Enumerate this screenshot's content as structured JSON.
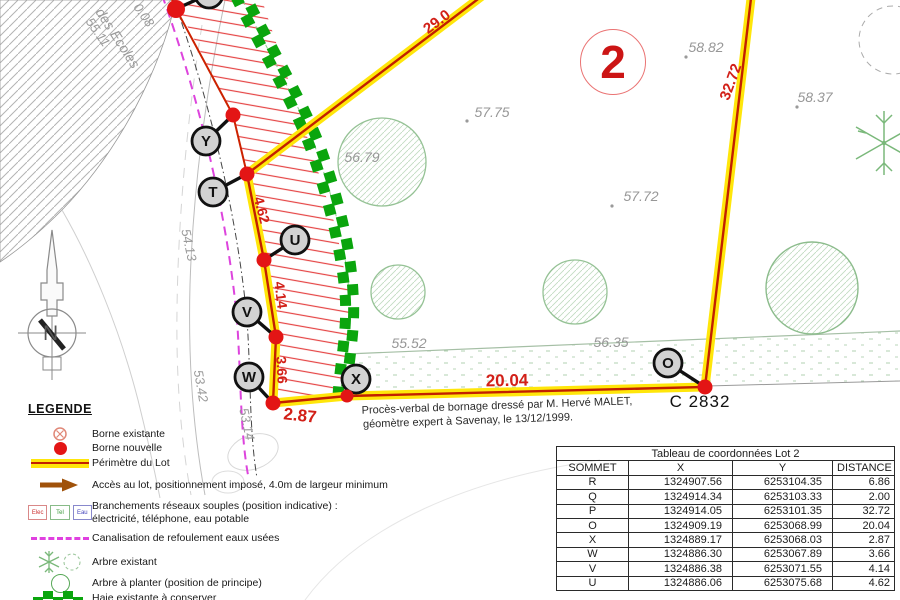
{
  "map": {
    "lot_number": "2",
    "parcel_label": "C 2832",
    "north_label": "N",
    "note_lines": [
      "Procès-verbal de bornage dressé par M. Hervé MALET,",
      "géomètre expert à Savenay, le 13/12/1999."
    ],
    "street_labels": [
      "0.08",
      "des Ecoles",
      "55.11",
      "54.13",
      "53.42",
      "53.14"
    ],
    "elevations": [
      "57.75",
      "58.82",
      "58.37",
      "57.72",
      "56.79",
      "55.52",
      "56.35"
    ],
    "segment_distances": [
      "29.0",
      "32.72",
      "4.62",
      "4.14",
      "3.66",
      "2.87",
      "20.04"
    ],
    "markers": [
      "Y",
      "T",
      "U",
      "V",
      "W",
      "X",
      "O"
    ]
  },
  "legend": {
    "title": "LEGENDE",
    "items": [
      {
        "label": "Borne existante"
      },
      {
        "label": "Borne nouvelle"
      },
      {
        "label": "Périmètre du Lot"
      },
      {
        "label": "Accès au lot, positionnement imposé, 4.0m de largeur minimum"
      },
      {
        "label": "Branchements réseaux souples (position indicative) :",
        "sublabel": "électricité, téléphone, eau potable"
      },
      {
        "label": "Canalisation de refoulement eaux usées"
      },
      {
        "label": "Arbre existant"
      },
      {
        "label": "Arbre à planter (position de principe)"
      },
      {
        "label": "Haie existante à conserver"
      }
    ],
    "utility_boxes": [
      "Elec",
      "Tel",
      "Eau"
    ]
  },
  "table": {
    "title": "Tableau de coordonnées Lot 2",
    "columns": [
      "SOMMET",
      "X",
      "Y",
      "DISTANCE"
    ],
    "rows": [
      [
        "R",
        "1324907.56",
        "6253104.35",
        "6.86"
      ],
      [
        "Q",
        "1324914.34",
        "6253103.33",
        "2.00"
      ],
      [
        "P",
        "1324914.05",
        "6253101.35",
        "32.72"
      ],
      [
        "O",
        "1324909.19",
        "6253068.99",
        "20.04"
      ],
      [
        "X",
        "1324889.17",
        "6253068.03",
        "2.87"
      ],
      [
        "W",
        "1324886.30",
        "6253067.89",
        "3.66"
      ],
      [
        "V",
        "1324886.38",
        "6253071.55",
        "4.14"
      ],
      [
        "U",
        "1324886.06",
        "6253075.68",
        "4.62"
      ]
    ]
  },
  "colors": {
    "perimeter_yellow": "#ffe60a",
    "perimeter_red": "#c22000",
    "hedge_green": "#0aa50d",
    "sewer_magenta": "#dd44dd",
    "lot_red": "#cc1515"
  }
}
